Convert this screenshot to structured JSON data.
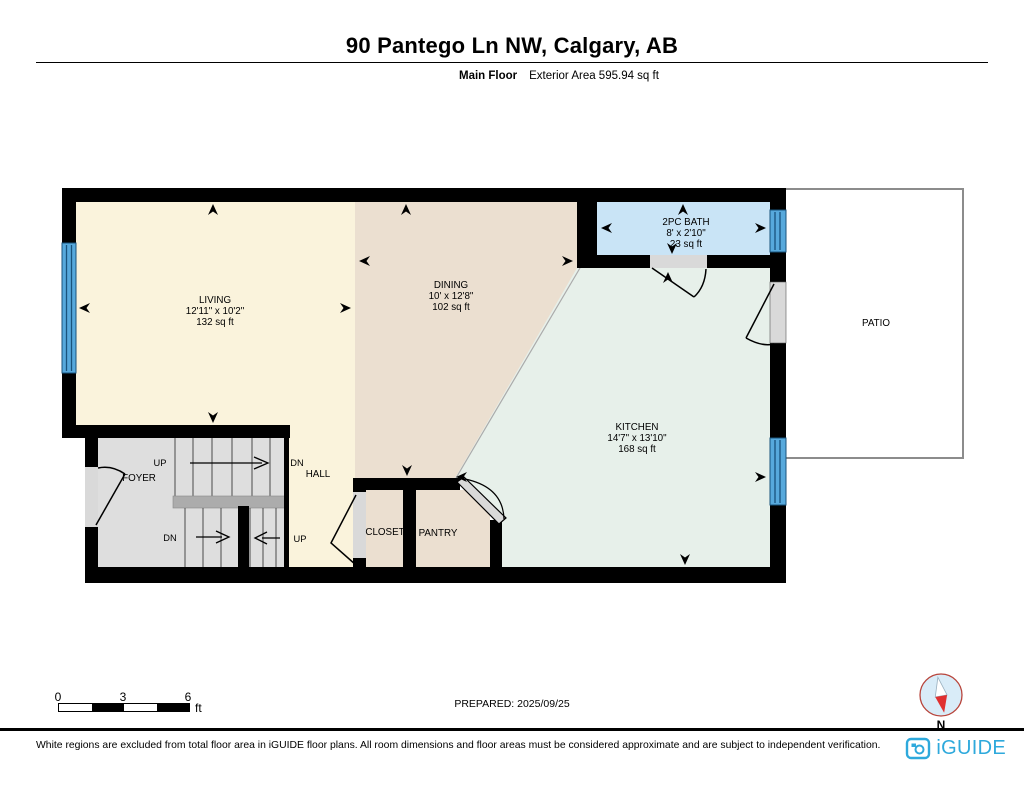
{
  "header": {
    "title": "90 Pantego Ln NW, Calgary, AB",
    "floor_label": "Main Floor",
    "area_label": "Exterior Area 595.94 sq ft"
  },
  "plan": {
    "rooms": [
      {
        "name": "LIVING",
        "dims": "12'11\" x 10'2\"",
        "area": "132 sq ft"
      },
      {
        "name": "DINING",
        "dims": "10' x 12'8\"",
        "area": "102 sq ft"
      },
      {
        "name": "2PC BATH",
        "dims": "8' x 2'10\"",
        "area": "23 sq ft"
      },
      {
        "name": "KITCHEN",
        "dims": "14'7\" x 13'10\"",
        "area": "168 sq ft"
      },
      {
        "name": "PATIO"
      },
      {
        "name": "FOYER"
      },
      {
        "name": "HALL"
      },
      {
        "name": "CLOSET"
      },
      {
        "name": "PANTRY"
      }
    ],
    "stair_labels": {
      "upper_up": "UP",
      "hall_dn": "DN",
      "lower_dn": "DN",
      "lower_up": "UP"
    }
  },
  "scale_bar": {
    "tick0": "0",
    "tick1": "3",
    "tick2": "6",
    "unit": "ft"
  },
  "prepared_label": "PREPARED: 2025/09/25",
  "compass": {
    "north_label": "N"
  },
  "footer": {
    "disclaimer": "White regions are excluded from total floor area in iGUIDE floor plans. All room dimensions and floor areas must be considered approximate and are subject to independent verification.",
    "brand": "iGUIDE"
  },
  "colors": {
    "living": "#FAF3DC",
    "dining": "#EBDFD0",
    "kitchen": "#E7F0EA",
    "bath": "#C9E4F6",
    "stairs": "#DEDEDE",
    "landing": "#ACACAC",
    "window": "#57A9DC",
    "window_line": "#19537C",
    "wall": "#000000",
    "door_slab": "#D9D9D9",
    "patio_border": "#8C8C8C",
    "brand": "#2EA9DC",
    "compass_red": "#E03030"
  }
}
